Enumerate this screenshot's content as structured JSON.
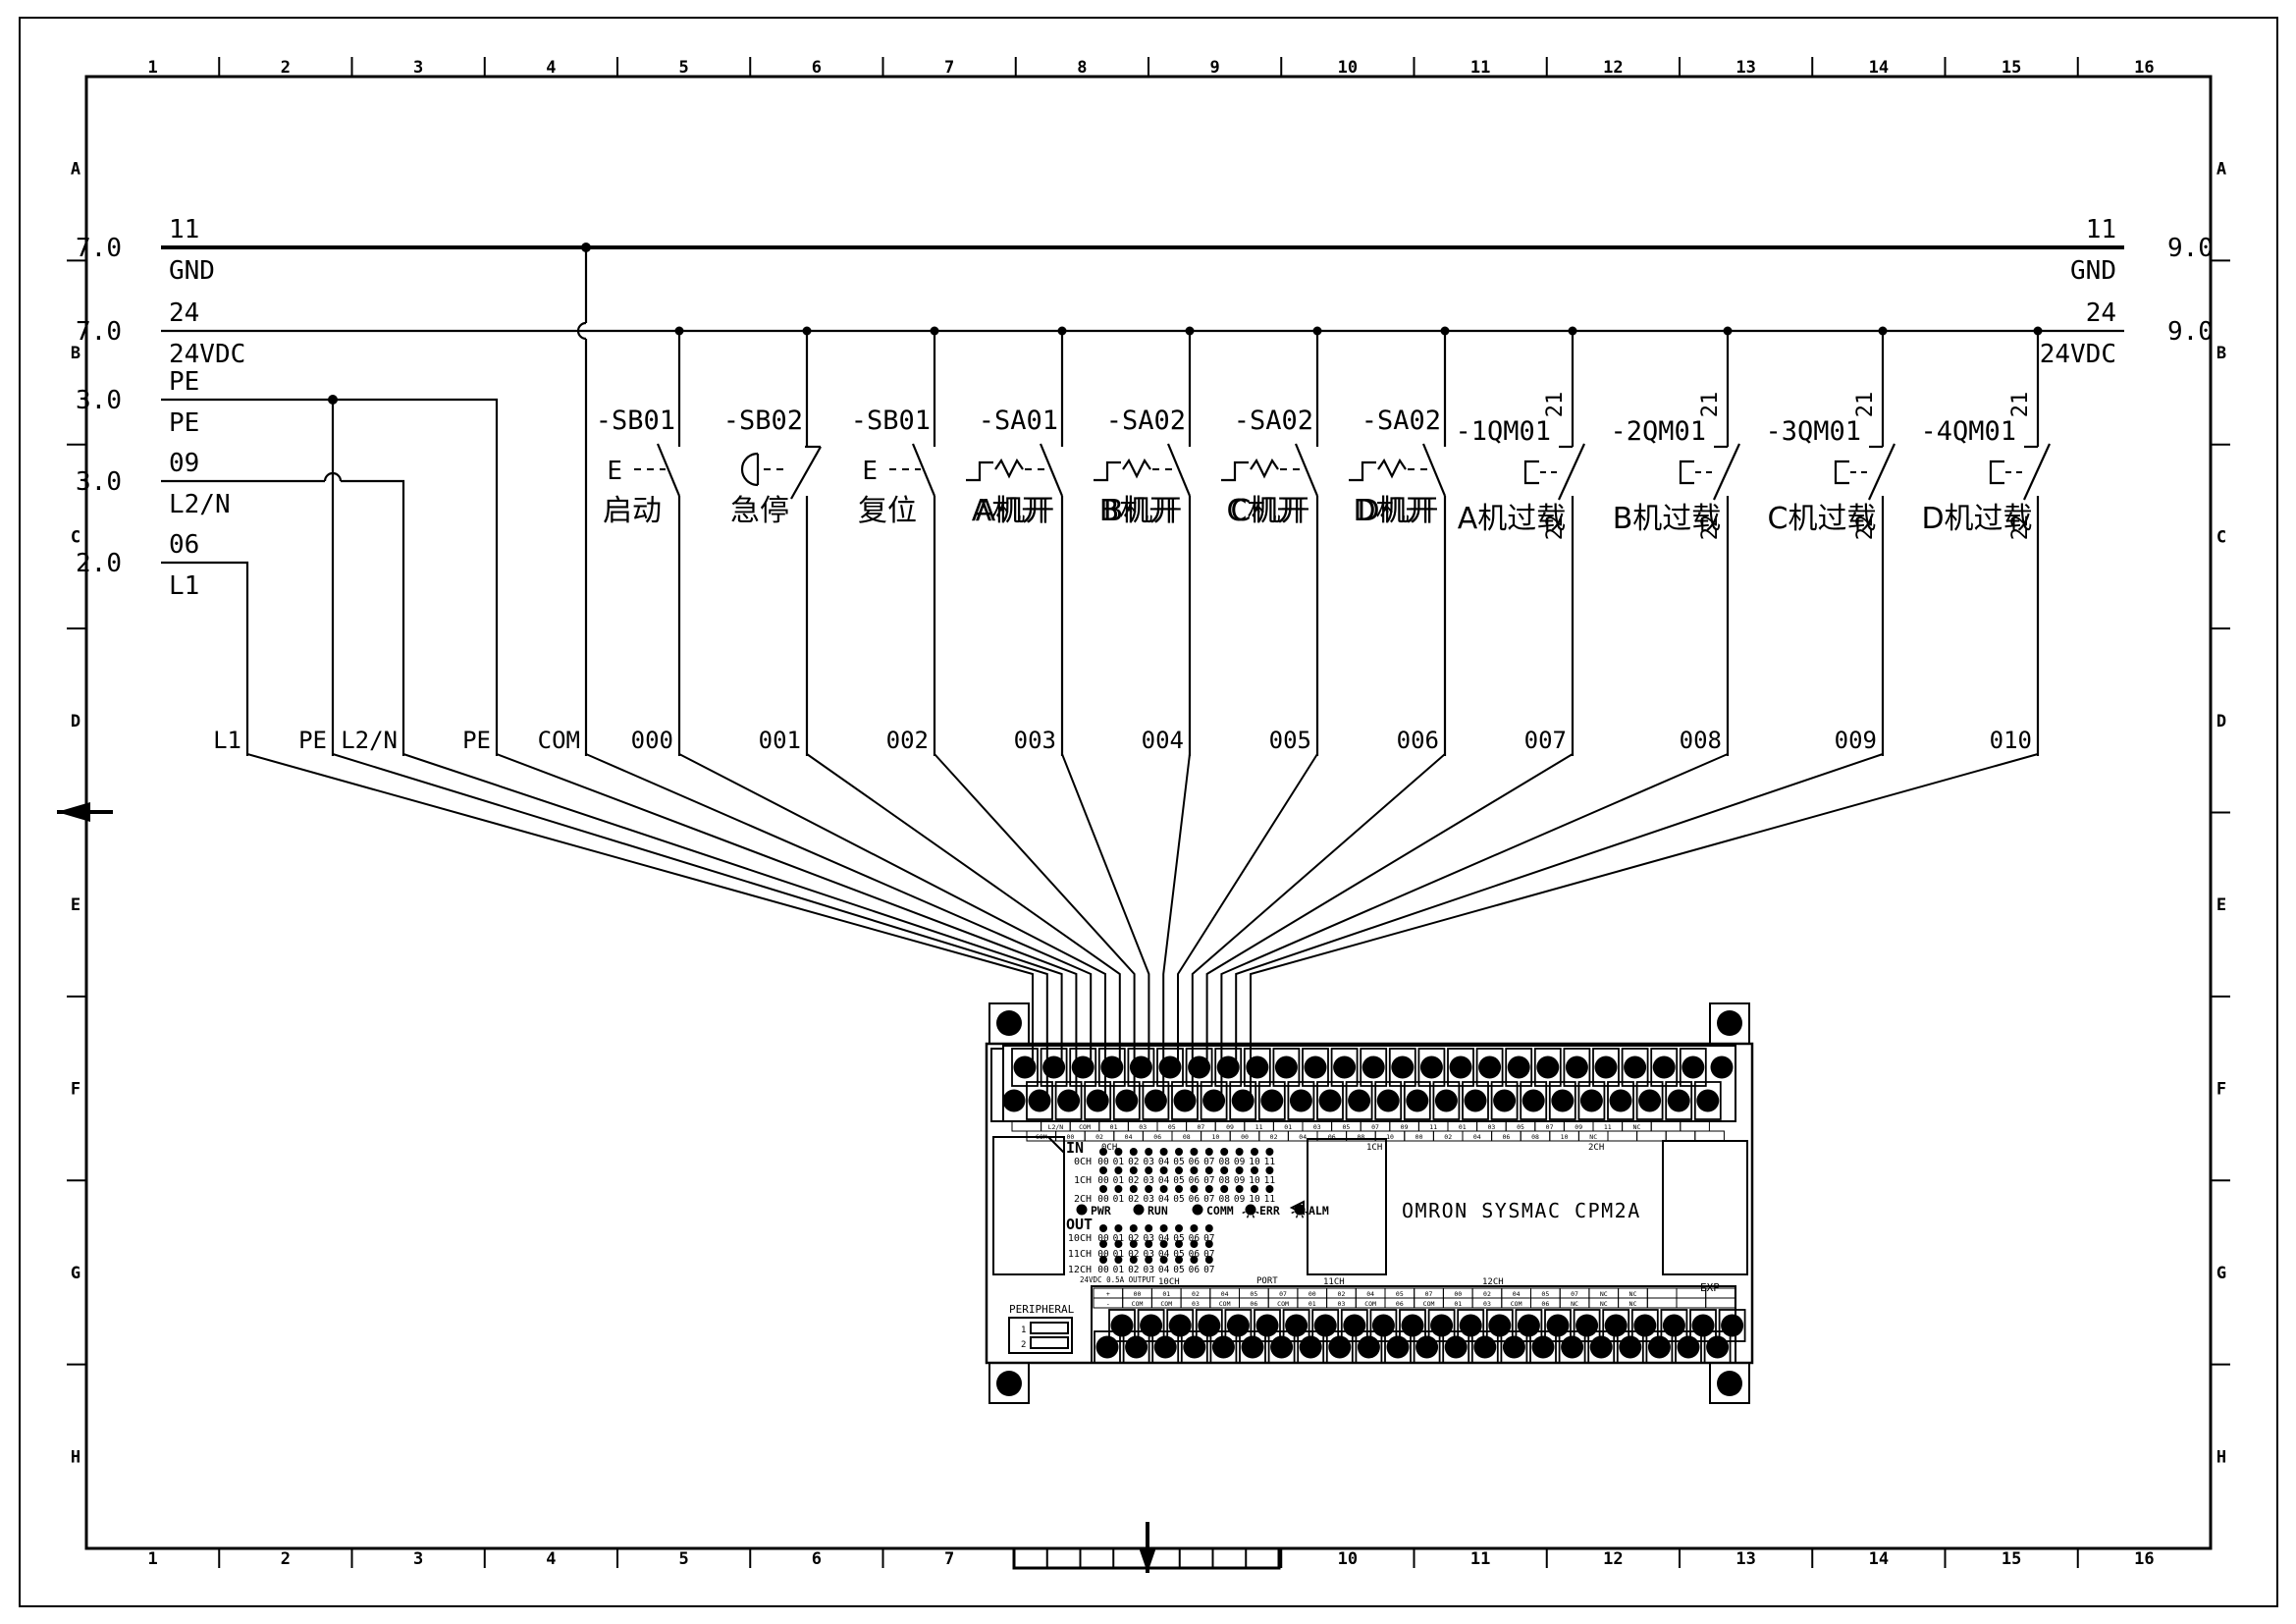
{
  "sheet": {
    "background": "#ffffff",
    "line_color": "#000000"
  },
  "frame": {
    "columns": [
      "1",
      "2",
      "3",
      "4",
      "5",
      "6",
      "7",
      "8",
      "9",
      "10",
      "11",
      "12",
      "13",
      "14",
      "15",
      "16"
    ],
    "rows": [
      "A",
      "B",
      "C",
      "D",
      "E",
      "F",
      "G",
      "H"
    ]
  },
  "left_entries": [
    {
      "ref": "7.0",
      "wire_no": "11",
      "label": "GND"
    },
    {
      "ref": "7.0",
      "wire_no": "24",
      "label": "24VDC"
    },
    {
      "ref": "3.0",
      "wire_no": "PE",
      "label": "PE"
    },
    {
      "ref": "3.0",
      "wire_no": "09",
      "label": "L2/N"
    },
    {
      "ref": "2.0",
      "wire_no": "06",
      "label": "L1"
    }
  ],
  "right_exits": [
    {
      "ref": "9.0",
      "wire_no": "11",
      "label": "GND"
    },
    {
      "ref": "9.0",
      "wire_no": "24",
      "label": "24VDC"
    }
  ],
  "feed_wire_labels": [
    "L1",
    "PE",
    "L2/N",
    "PE",
    "COM"
  ],
  "switches": [
    {
      "id": "-SB01",
      "name_cn": "启动",
      "type": "pushbutton_no",
      "wire": "000"
    },
    {
      "id": "-SB02",
      "name_cn": "急停",
      "type": "estop_nc",
      "wire": "001"
    },
    {
      "id": "-SB01",
      "name_cn": "复位",
      "type": "pushbutton_no",
      "wire": "002"
    },
    {
      "id": "-SA01",
      "name_cn": "A机开",
      "type": "selector_no",
      "wire": "003"
    },
    {
      "id": "-SA02",
      "name_cn": "B机开",
      "type": "selector_no",
      "wire": "004"
    },
    {
      "id": "-SA02",
      "name_cn": "C机开",
      "type": "selector_no",
      "wire": "005"
    },
    {
      "id": "-SA02",
      "name_cn": "D机开",
      "type": "selector_no",
      "wire": "006"
    },
    {
      "id": "-1QM01",
      "name_cn": "A机过载",
      "type": "overload_nc",
      "terminal_top": "21",
      "terminal_bottom": "22",
      "wire": "007"
    },
    {
      "id": "-2QM01",
      "name_cn": "B机过载",
      "type": "overload_nc",
      "terminal_top": "21",
      "terminal_bottom": "22",
      "wire": "008"
    },
    {
      "id": "-3QM01",
      "name_cn": "C机过载",
      "type": "overload_nc",
      "terminal_top": "21",
      "terminal_bottom": "22",
      "wire": "009"
    },
    {
      "id": "-4QM01",
      "name_cn": "D机过载",
      "type": "overload_nc",
      "terminal_top": "21",
      "terminal_bottom": "22",
      "wire": "010"
    }
  ],
  "plc": {
    "model": "OMRON SYSMAC CPM2A",
    "in_label": "IN",
    "out_label": "OUT",
    "status_leds": [
      "PWR",
      "RUN",
      "COMM",
      "ERR",
      "ALM"
    ],
    "in_channels": [
      {
        "ch": "0CH",
        "points": [
          "00",
          "01",
          "02",
          "03",
          "04",
          "05",
          "06",
          "07",
          "08",
          "09",
          "10",
          "11"
        ]
      },
      {
        "ch": "1CH",
        "points": [
          "00",
          "01",
          "02",
          "03",
          "04",
          "05",
          "06",
          "07",
          "08",
          "09",
          "10",
          "11"
        ]
      },
      {
        "ch": "2CH",
        "points": [
          "00",
          "01",
          "02",
          "03",
          "04",
          "05",
          "06",
          "07",
          "08",
          "09",
          "10",
          "11"
        ]
      }
    ],
    "out_channels": [
      {
        "ch": "10CH",
        "points": [
          "00",
          "01",
          "02",
          "03",
          "04",
          "05",
          "06",
          "07"
        ]
      },
      {
        "ch": "11CH",
        "points": [
          "00",
          "01",
          "02",
          "03",
          "04",
          "05",
          "06",
          "07"
        ]
      },
      {
        "ch": "12CH",
        "points": [
          "00",
          "01",
          "02",
          "03",
          "04",
          "05",
          "06",
          "07"
        ]
      }
    ],
    "top_strip_markers": [
      "0CH",
      "1CH",
      "2CH"
    ],
    "bottom_strip_markers": [
      "10CH",
      "11CH",
      "12CH"
    ],
    "port_label": "PORT",
    "peripheral_label": "PERIPHERAL",
    "exp_label": "EXP",
    "output_rating": "24VDC 0.5A OUTPUT",
    "dip_switch": [
      "1",
      "2"
    ],
    "top_terminal_row1": [
      "",
      "L2/N",
      "COM",
      "01",
      "03",
      "05",
      "07",
      "09",
      "11",
      "01",
      "03",
      "05",
      "07",
      "09",
      "11",
      "01",
      "03",
      "05",
      "07",
      "09",
      "11",
      "NC",
      "",
      ""
    ],
    "top_terminal_row2": [
      "COM",
      "00",
      "02",
      "04",
      "06",
      "08",
      "10",
      "00",
      "02",
      "04",
      "06",
      "08",
      "10",
      "00",
      "02",
      "04",
      "06",
      "08",
      "10",
      "NC",
      "",
      "",
      "",
      ""
    ],
    "bottom_terminal_row1": [
      "+",
      "00",
      "01",
      "02",
      "04",
      "05",
      "07",
      "00",
      "02",
      "04",
      "05",
      "07",
      "00",
      "02",
      "04",
      "05",
      "07",
      "NC",
      "NC",
      "",
      "",
      ""
    ],
    "bottom_terminal_row2": [
      "-",
      "COM",
      "COM",
      "03",
      "COM",
      "06",
      "COM",
      "01",
      "03",
      "COM",
      "06",
      "COM",
      "01",
      "03",
      "COM",
      "06",
      "NC",
      "NC",
      "NC",
      "",
      "",
      ""
    ]
  }
}
